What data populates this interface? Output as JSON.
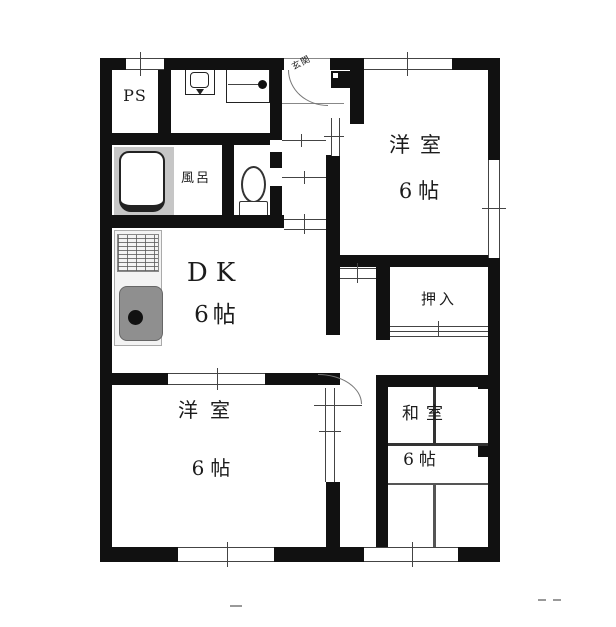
{
  "floorplan": {
    "labels": {
      "ps": "PS",
      "genkan": "玄関",
      "bath": "風呂",
      "dk_name": "DK",
      "dk_size": "6帖",
      "western_room_top_name": "洋室",
      "western_room_top_size": "6帖",
      "closet": "押入",
      "western_room_bottom_name": "洋室",
      "western_room_bottom_size": "6帖",
      "japanese_room_name": "和室",
      "japanese_room_size": "6帖"
    },
    "colors": {
      "wall": "#111111",
      "line": "#444444",
      "bath_floor": "#c6c6c6",
      "sink": "#8f8f8f",
      "counter": "#f3f3f3",
      "text": "#1c1c1c",
      "background": "#ffffff"
    }
  }
}
